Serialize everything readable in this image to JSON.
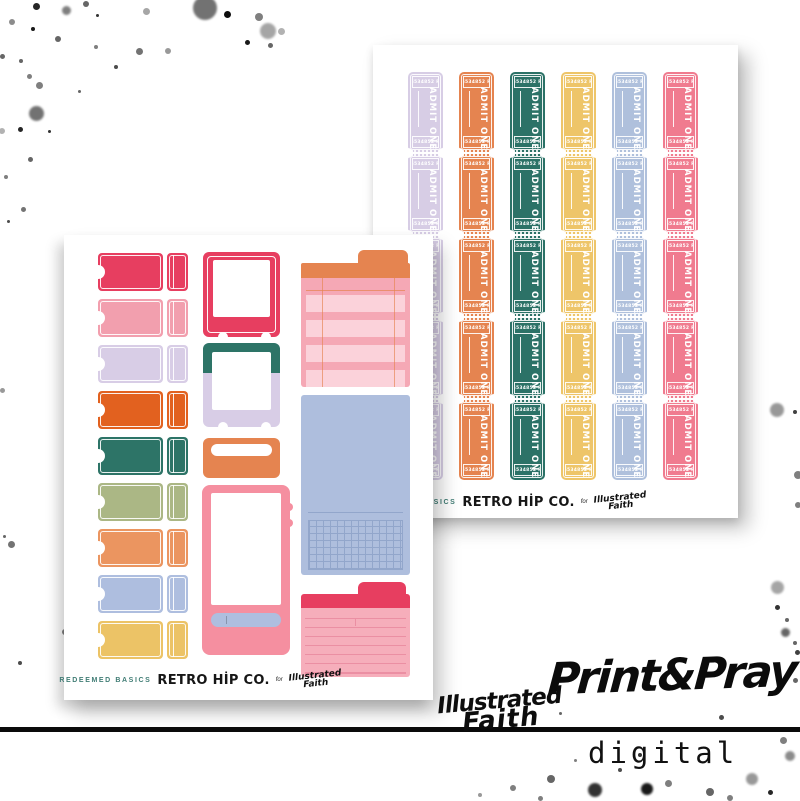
{
  "logo": {
    "line1": "Illustrated",
    "line2": "Faith"
  },
  "branding": {
    "title": "Print&Pray",
    "subtitle": "digital"
  },
  "sheets": {
    "back": {
      "ticket_number": "6534852 R",
      "admit_text": "ADMIT ONE",
      "rows": 5,
      "column_colors": [
        "#d7cde5",
        "#e58450",
        "#2c7267",
        "#eec569",
        "#afc0dc",
        "#f07b8f"
      ],
      "footer": {
        "series": "REDEEMED BASICS",
        "brand": "RETRO HİP CO.",
        "conj": "for"
      }
    },
    "front": {
      "stub_colors": [
        "#e73e60",
        "#f29fae",
        "#d8cde6",
        "#e2611f",
        "#2d7467",
        "#abb785",
        "#eb9560",
        "#aebedf",
        "#ecc366"
      ],
      "frame1_color": "#e73e60",
      "frame2_top_color": "#2d7467",
      "frame2_bottom_color": "#d8cde6",
      "label_box_color": "#e58450",
      "phone_color": "#f58fa0",
      "phone_bar_color": "#aebedf",
      "tracker": {
        "tab_color": "#e58450",
        "body_color": "#f5a8b5",
        "stripe_color": "#fbd2da",
        "line_color": "#e58450",
        "stripes": 4
      },
      "grid_box": {
        "color": "#aebedd",
        "line_color": "#92a6cb"
      },
      "notecard": {
        "tab_color": "#e73e60",
        "body_color": "#f6aebb",
        "line_color": "#eb8fa3",
        "lines": 7
      },
      "footer": {
        "series": "REDEEMED BASICS",
        "brand": "RETRO HİP CO.",
        "conj": "for"
      }
    }
  },
  "splatters": [
    [
      36,
      6,
      7,
      0.85
    ],
    [
      66,
      10,
      9,
      0.5
    ],
    [
      86,
      4,
      6,
      0.6
    ],
    [
      12,
      22,
      6,
      0.45
    ],
    [
      33,
      29,
      4,
      0.9
    ],
    [
      97,
      15,
      3,
      0.8
    ],
    [
      146,
      11,
      7,
      0.35
    ],
    [
      205,
      8,
      24,
      0.55
    ],
    [
      227,
      14,
      7,
      0.95
    ],
    [
      259,
      17,
      8,
      0.5
    ],
    [
      268,
      31,
      16,
      0.35
    ],
    [
      247,
      42,
      5,
      0.9
    ],
    [
      281,
      31,
      7,
      0.3
    ],
    [
      270,
      45,
      5,
      0.6
    ],
    [
      58,
      39,
      6,
      0.6
    ],
    [
      96,
      47,
      4,
      0.5
    ],
    [
      139,
      51,
      7,
      0.55
    ],
    [
      168,
      51,
      6,
      0.4
    ],
    [
      2,
      56,
      5,
      0.6
    ],
    [
      21,
      61,
      4,
      0.6
    ],
    [
      116,
      67,
      4,
      0.7
    ],
    [
      29,
      76,
      5,
      0.5
    ],
    [
      39,
      85,
      7,
      0.5
    ],
    [
      79,
      91,
      3,
      0.6
    ],
    [
      36,
      113,
      15,
      0.55
    ],
    [
      20,
      129,
      5,
      0.85
    ],
    [
      2,
      131,
      6,
      0.3
    ],
    [
      49,
      131,
      3,
      0.8
    ],
    [
      30,
      159,
      5,
      0.6
    ],
    [
      6,
      177,
      4,
      0.5
    ],
    [
      23,
      209,
      5,
      0.55
    ],
    [
      8,
      221,
      3,
      0.7
    ],
    [
      2,
      390,
      5,
      0.4
    ],
    [
      11,
      544,
      7,
      0.55
    ],
    [
      4,
      536,
      3,
      0.6
    ],
    [
      65,
      632,
      6,
      0.5
    ],
    [
      20,
      663,
      4,
      0.7
    ],
    [
      777,
      410,
      14,
      0.4
    ],
    [
      795,
      412,
      4,
      0.75
    ],
    [
      798,
      475,
      8,
      0.5
    ],
    [
      798,
      505,
      6,
      0.5
    ],
    [
      777,
      587,
      13,
      0.35
    ],
    [
      777,
      607,
      5,
      0.8
    ],
    [
      787,
      620,
      4,
      0.6
    ],
    [
      785,
      632,
      9,
      0.6
    ],
    [
      795,
      643,
      4,
      0.6
    ],
    [
      797,
      652,
      5,
      0.75
    ],
    [
      513,
      788,
      6,
      0.5
    ],
    [
      551,
      779,
      8,
      0.6
    ],
    [
      595,
      790,
      14,
      0.8
    ],
    [
      647,
      789,
      12,
      0.9
    ],
    [
      668,
      783,
      7,
      0.5
    ],
    [
      710,
      792,
      8,
      0.6
    ],
    [
      752,
      779,
      12,
      0.4
    ],
    [
      783,
      740,
      7,
      0.5
    ],
    [
      790,
      756,
      10,
      0.45
    ],
    [
      795,
      680,
      5,
      0.6
    ],
    [
      721,
      717,
      5,
      0.7
    ],
    [
      560,
      713,
      3,
      0.6
    ],
    [
      620,
      770,
      4,
      0.7
    ],
    [
      575,
      760,
      3,
      0.5
    ],
    [
      540,
      798,
      5,
      0.5
    ],
    [
      480,
      795,
      4,
      0.4
    ],
    [
      640,
      755,
      4,
      0.8
    ],
    [
      770,
      792,
      5,
      0.85
    ],
    [
      730,
      798,
      6,
      0.5
    ]
  ]
}
